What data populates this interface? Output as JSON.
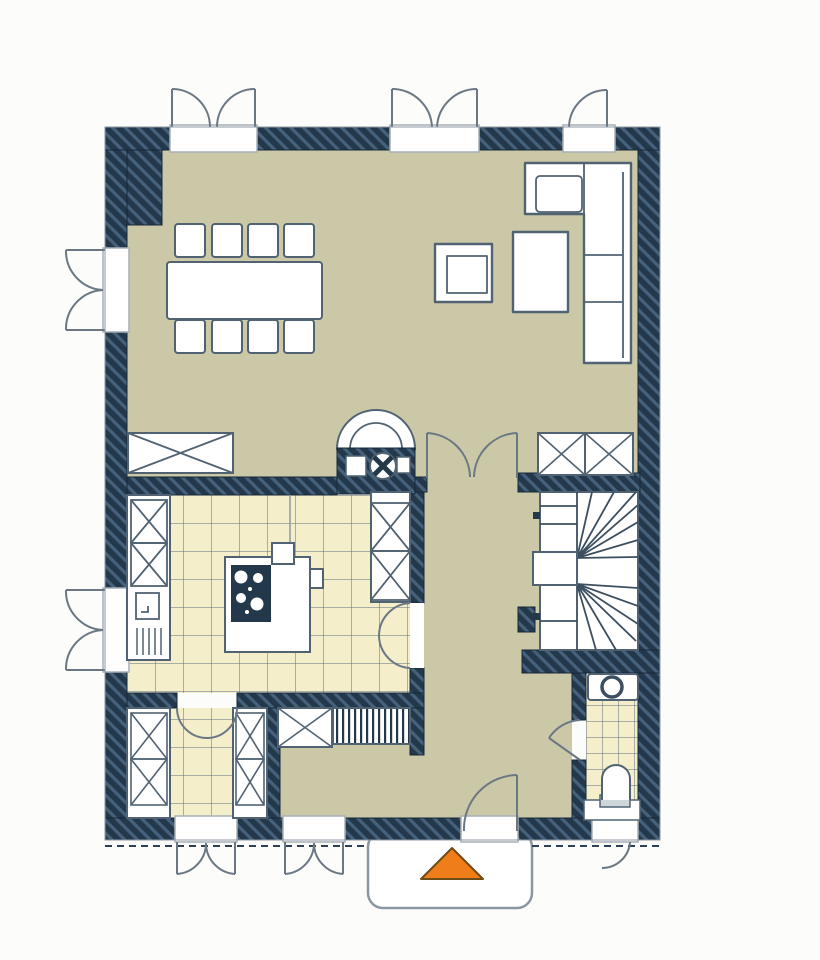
{
  "plan": {
    "kind": "residential-floor-plan",
    "storey": "ground-floor"
  },
  "colors": {
    "background": "#fcfcfa",
    "wall": "#23394b",
    "wall_hatch": "#46617b",
    "wall_edge": "#16283a",
    "floor_main": "#cac8a7",
    "floor_tile": "#f4eeca",
    "tile_line": "#5d6f7c",
    "furniture_fill": "#ffffff",
    "furniture_stroke": "#516372",
    "door_arc": "#6b7884",
    "sill": "#a7b0b7",
    "stair_line": "#3c4f60",
    "porch_stroke": "#8a96a0",
    "dash_line": "#2c4254",
    "accent_orange": "#ef7d1a",
    "accent_orange_edge": "#6e4d16"
  },
  "markers": {
    "entrance_arrow": "orange-triangle-pointing-up"
  }
}
